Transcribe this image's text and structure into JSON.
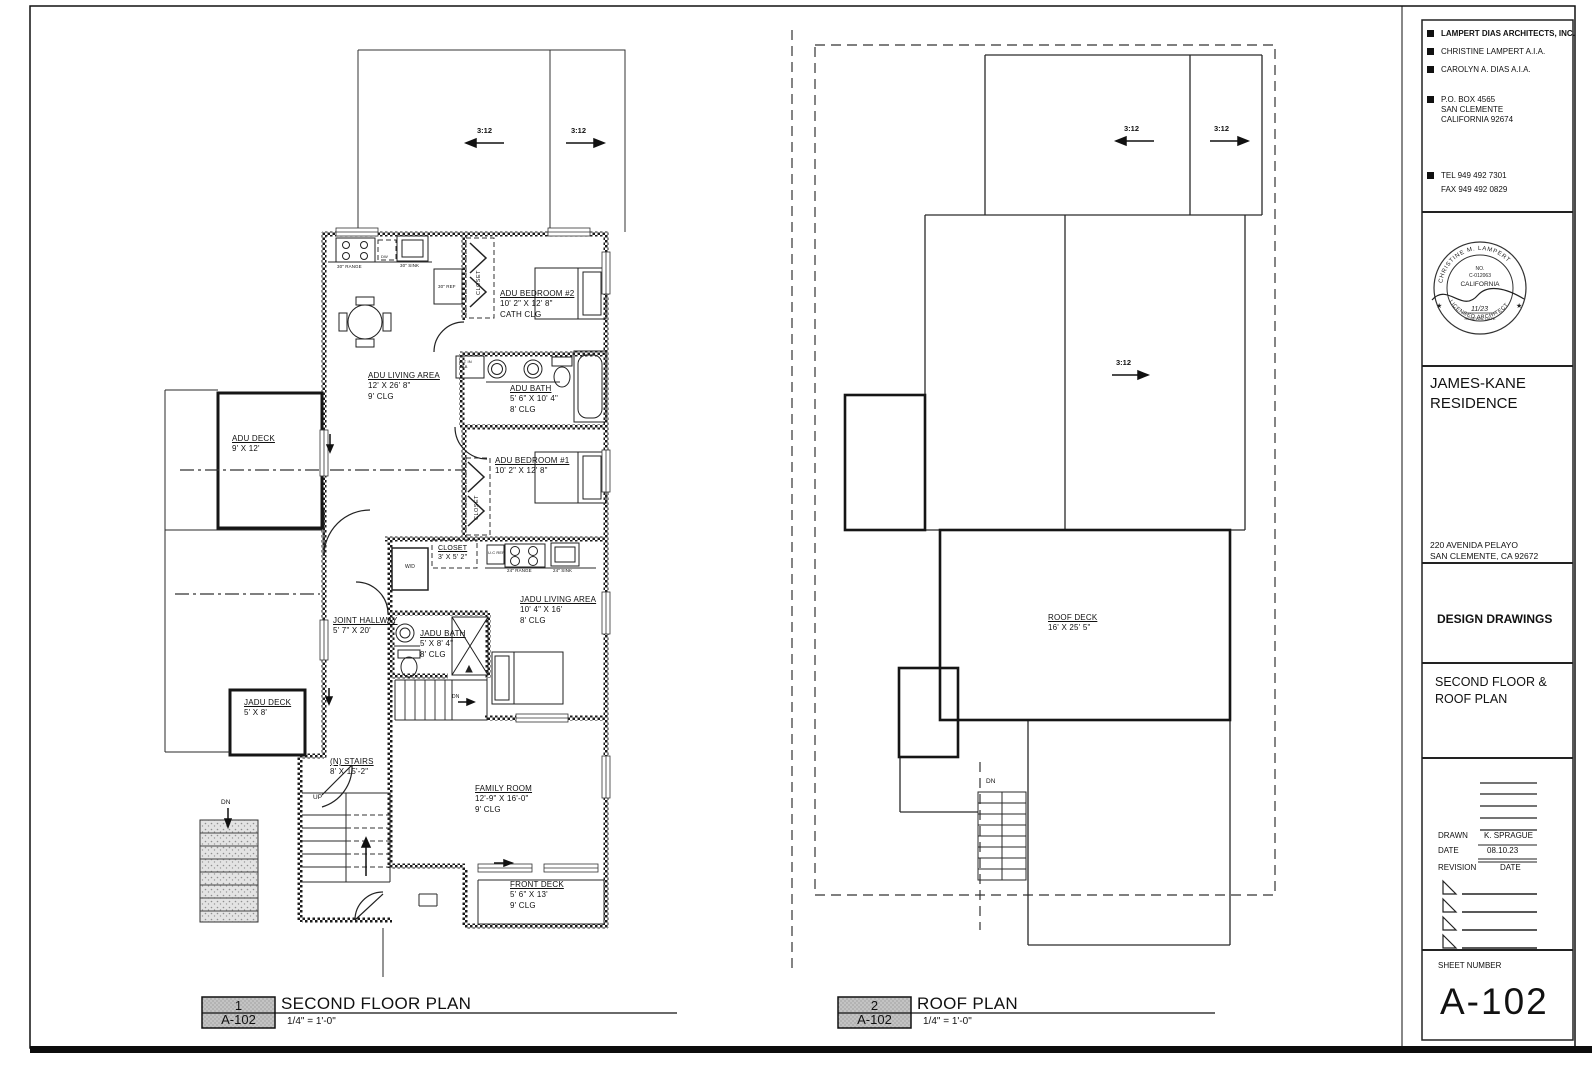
{
  "titleblock": {
    "firm": "LAMPERT DIAS ARCHITECTS, INC.",
    "architect1": "CHRISTINE LAMPERT A.I.A.",
    "architect2": "CAROLYN A. DIAS  A.I.A.",
    "po_box": "P.O. BOX 4565",
    "po_city": "SAN CLEMENTE",
    "po_state": "CALIFORNIA 92674",
    "tel": "TEL 949 492 7301",
    "fax": "FAX 949 492 0829",
    "stamp": {
      "arc_top": "CHRISTINE M. LAMPERT",
      "no": "NO.",
      "license": "C-012063",
      "state": "CALIFORNIA",
      "date": "11/23",
      "renewal": "RENEWAL DATE",
      "arc_bottom": "LICENSED ARCHITECT"
    },
    "project": "JAMES-KANE RESIDENCE",
    "address1": "220 AVENIDA PELAYO",
    "address2": "SAN CLEMENTE, CA 92672",
    "phase": "DESIGN DRAWINGS",
    "sheet_title": "SECOND FLOOR & ROOF PLAN",
    "drawn_label": "DRAWN",
    "drawn_value": "K. SPRAGUE",
    "date_label": "DATE",
    "date_value": "08.10.23",
    "revision_label": "REVISION",
    "revision_date_label": "DATE",
    "sheet_number_label": "SHEET NUMBER",
    "sheet_number": "A-102"
  },
  "plan1": {
    "callout_number": "1",
    "callout_sheet": "A-102",
    "title": "SECOND FLOOR PLAN",
    "scale": "1/4\" = 1'-0\"",
    "pitch_left": "3:12",
    "pitch_right": "3:12",
    "labels": {
      "adu_bed2": {
        "l1": "ADU BEDROOM #2",
        "l2": "10' 2\" X 12' 8\"",
        "l3": "CATH CLG"
      },
      "adu_living": {
        "l1": "ADU LIVING AREA",
        "l2": "12' X 26' 8\"",
        "l3": "9' CLG"
      },
      "adu_bath": {
        "l1": "ADU BATH",
        "l2": "5' 6\" X 10' 4\"",
        "l3": "8' CLG"
      },
      "adu_bed1": {
        "l1": "ADU BEDROOM #1",
        "l2": "10' 2\" X 12' 8\""
      },
      "adu_deck": {
        "l1": "ADU DECK",
        "l2": "9' X 12'"
      },
      "closet_small": {
        "l1": "CLOSET",
        "l2": "3' X 5' 2\""
      },
      "jadu_living": {
        "l1": "JADU LIVING AREA",
        "l2": "10' 4\" X 16'",
        "l3": "8' CLG"
      },
      "jadu_bath": {
        "l1": "JADU BATH",
        "l2": "5' X 8' 4\"",
        "l3": "8' CLG"
      },
      "joint_hall": {
        "l1": "JOINT HALLWAY",
        "l2": "5' 7\" X 20'"
      },
      "jadu_deck": {
        "l1": "JADU DECK",
        "l2": "5' X 8'"
      },
      "n_stairs": {
        "l1": "(N) STAIRS",
        "l2": "8' X 15'-2\""
      },
      "family": {
        "l1": "FAMILY ROOM",
        "l2": "12'-9\" X 16'-0\"",
        "l3": "9' CLG"
      },
      "front_deck": {
        "l1": "FRONT DECK",
        "l2": "5' 6\" X 13'",
        "l3": "9' CLG"
      }
    },
    "fixtures": {
      "range30": "30\" RANGE",
      "dw": "DW",
      "sink30": "30\" SINK",
      "ref30": "30\" REF",
      "closet1": "CLOSET",
      "closet2": "CLOSET",
      "blt_in": "BLT IN CAB",
      "ucref": "U.C REF",
      "range24": "24\" RANGE",
      "sink24": "24\" SINK",
      "wd": "W/D",
      "up": "UP",
      "dn_exterior": "DN",
      "dn_interior": "DN"
    }
  },
  "plan2": {
    "callout_number": "2",
    "callout_sheet": "A-102",
    "title": "ROOF PLAN",
    "scale": "1/4\" = 1'-0\"",
    "pitch_left": "3:12",
    "pitch_right": "3:12",
    "pitch_mid": "3:12",
    "roof_deck": {
      "l1": "ROOF DECK",
      "l2": "16' X 25' 5\""
    },
    "dn": "DN"
  }
}
